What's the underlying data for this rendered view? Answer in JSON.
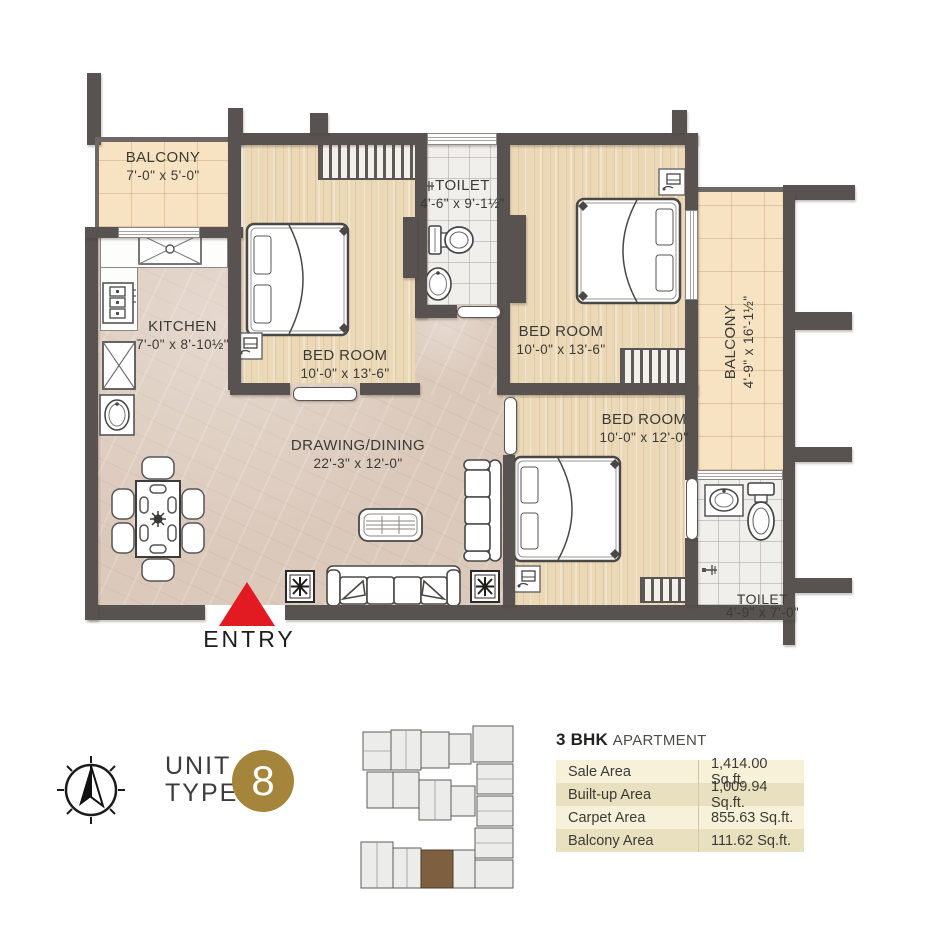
{
  "plan": {
    "rooms": [
      {
        "id": "balcony-top",
        "name": "BALCONY",
        "dims": "7'-0\" x 5'-0\""
      },
      {
        "id": "kitchen",
        "name": "KITCHEN",
        "dims": "7'-0\" x 8'-10½\""
      },
      {
        "id": "bedroom-1",
        "name": "BED ROOM",
        "dims": "10'-0\" x 13'-6\""
      },
      {
        "id": "toilet-1",
        "name": "TOILET",
        "dims": "4'-6\" x 9'-1½\""
      },
      {
        "id": "bedroom-2",
        "name": "BED ROOM",
        "dims": "10'-0\" x 13'-6\""
      },
      {
        "id": "balcony-right",
        "name": "BALCONY",
        "dims": "4'-9\" x 16'-1½\""
      },
      {
        "id": "bedroom-3",
        "name": "BED ROOM",
        "dims": "10'-0\" x 12'-0\""
      },
      {
        "id": "toilet-2",
        "name": "TOILET",
        "dims": "4'-9\" x 7'-0\""
      },
      {
        "id": "drawing-dining",
        "name": "DRAWING/DINING",
        "dims": "22'-3\" x 12'-0\""
      }
    ],
    "entry_label": "ENTRY"
  },
  "unit": {
    "line1": "UNIT",
    "line2": "TYPE",
    "number": "8"
  },
  "info_table": {
    "title_bold": "3 BHK",
    "title_light": "APARTMENT",
    "rows": [
      {
        "label": "Sale Area",
        "value": "1,414.00 Sq.ft."
      },
      {
        "label": "Built-up Area",
        "value": "1,009.94 Sq.ft."
      },
      {
        "label": "Carpet Area",
        "value": "855.63 Sq.ft."
      },
      {
        "label": "Balcony Area",
        "value": "111.62 Sq.ft."
      }
    ]
  },
  "icons": {
    "compass": "north-compass-icon",
    "key_plan": "building-key-plan-thumbnail",
    "entry_marker": "entry-arrow"
  },
  "colors": {
    "wall": "#585250",
    "entry_red": "#e21b23",
    "gold": "#a5853c",
    "table_row_light": "#f7f1da",
    "table_row_dark": "#e9e0bf",
    "wood_floor": "#ebd8b6",
    "marble_floor": "#dbc9bb",
    "balcony_tile": "#f7e3c2",
    "bath_tile": "#f0efec"
  }
}
